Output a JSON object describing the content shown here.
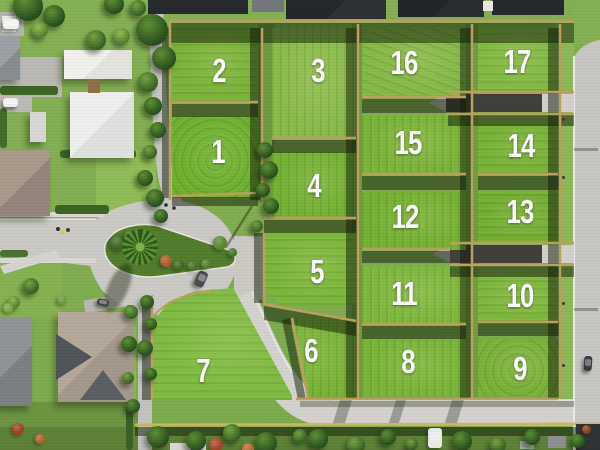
{
  "lots": [
    {
      "label": "1",
      "x": 172,
      "y": 116,
      "w": 86,
      "h": 82,
      "color": "#6db02d",
      "tex": "radial",
      "ang": 0,
      "lx": 218,
      "ly": 152
    },
    {
      "label": "2",
      "x": 172,
      "y": 28,
      "w": 86,
      "h": 74,
      "color": "#7ab238",
      "tex": "linear",
      "ang": 0,
      "lx": 219,
      "ly": 71
    },
    {
      "label": "3",
      "x": 272,
      "y": 28,
      "w": 84,
      "h": 110,
      "color": "#8aba4a",
      "tex": "linear",
      "ang": 90,
      "lx": 318,
      "ly": 71
    },
    {
      "label": "4",
      "x": 272,
      "y": 152,
      "w": 84,
      "h": 66,
      "color": "#74b134",
      "tex": "linear",
      "ang": 90,
      "lx": 314,
      "ly": 186
    },
    {
      "label": "5",
      "x": 264,
      "y": 233,
      "w": 92,
      "h": 72,
      "color": "#7bb63a",
      "tex": "linear",
      "ang": 0,
      "lx": 317,
      "ly": 272,
      "clip": "polygon(0% 0%,100% 0%,100% 100%,16% 100%,0% 74%)"
    },
    {
      "label": "6",
      "x": 264,
      "y": 318,
      "w": 92,
      "h": 80,
      "color": "#78b236",
      "tex": "linear",
      "ang": 90,
      "lx": 311,
      "ly": 351,
      "clip": "polygon(28% 0%,100% 0%,100% 100%,48% 100%)"
    },
    {
      "label": "7",
      "x": 152,
      "y": 288,
      "w": 140,
      "h": 112,
      "color": "#7fbb40",
      "tex": "linear",
      "ang": 0,
      "lx": 203,
      "ly": 371,
      "clip": "polygon(0% 32%,12% 12%,30% 3%,58% 0%,100% 96%,100% 100%,0% 100%)"
    },
    {
      "label": "8",
      "x": 362,
      "y": 340,
      "w": 104,
      "h": 56,
      "color": "#79b437",
      "tex": "linear",
      "ang": 90,
      "lx": 408,
      "ly": 362
    },
    {
      "label": "9",
      "x": 478,
      "y": 340,
      "w": 80,
      "h": 56,
      "color": "#7ab138",
      "tex": "radial",
      "ang": 0,
      "lx": 520,
      "ly": 369
    },
    {
      "label": "10",
      "x": 478,
      "y": 274,
      "w": 80,
      "h": 48,
      "color": "#7db63c",
      "tex": "linear",
      "ang": 0,
      "lx": 520,
      "ly": 296
    },
    {
      "label": "11",
      "x": 362,
      "y": 266,
      "w": 104,
      "h": 59,
      "color": "#7eb73d",
      "tex": "linear",
      "ang": 90,
      "lx": 404,
      "ly": 294
    },
    {
      "label": "12",
      "x": 362,
      "y": 192,
      "w": 104,
      "h": 58,
      "color": "#75b032",
      "tex": "linear",
      "ang": 90,
      "lx": 405,
      "ly": 217
    },
    {
      "label": "13",
      "x": 478,
      "y": 192,
      "w": 80,
      "h": 52,
      "color": "#73ae31",
      "tex": "linear",
      "ang": 0,
      "lx": 520,
      "ly": 212
    },
    {
      "label": "14",
      "x": 478,
      "y": 124,
      "w": 80,
      "h": 50,
      "color": "#77b235",
      "tex": "linear",
      "ang": 0,
      "lx": 521,
      "ly": 146
    },
    {
      "label": "15",
      "x": 362,
      "y": 116,
      "w": 104,
      "h": 59,
      "color": "#7ab338",
      "tex": "linear",
      "ang": 90,
      "lx": 408,
      "ly": 143
    },
    {
      "label": "16",
      "x": 362,
      "y": 28,
      "w": 104,
      "h": 70,
      "color": "#85b846",
      "tex": "linear",
      "ang": 20,
      "lx": 404,
      "ly": 63
    },
    {
      "label": "17",
      "x": 478,
      "y": 28,
      "w": 80,
      "h": 63,
      "color": "#82b942",
      "tex": "linear",
      "ang": 0,
      "lx": 517,
      "ly": 62
    }
  ],
  "palette": {
    "grass_base": "#82ab51",
    "road": "#cbc9c5",
    "road_light": "#dbd9d5",
    "asphalt": "#403e39",
    "fence_tan": "#bba05e",
    "fence_bright": "#cfb35f",
    "shadow": "rgba(16,26,6,0.5)",
    "island_green": "#527c2c",
    "label_white": "#ffffff",
    "roof_dark": "#23262a",
    "roof_white": "#f1f0ec"
  },
  "scenery": {
    "lawns": [
      {
        "x": 96,
        "y": 150,
        "w": 60,
        "h": 68,
        "c": "#8fbb57"
      },
      {
        "x": 56,
        "y": 326,
        "w": 80,
        "h": 76,
        "c": "#8abc52"
      },
      {
        "x": 0,
        "y": 256,
        "w": 62,
        "h": 62,
        "c": "#86b150"
      },
      {
        "x": 0,
        "y": 402,
        "w": 138,
        "h": 48,
        "c": "#6d9441"
      },
      {
        "x": 0,
        "y": 427,
        "w": 600,
        "h": 23,
        "c": "#5d8038"
      },
      {
        "x": 258,
        "y": 24,
        "w": 16,
        "h": 178,
        "c": "#6f9a3e"
      },
      {
        "x": 352,
        "y": 24,
        "w": 10,
        "h": 374,
        "c": "#6f9a3e"
      },
      {
        "x": 466,
        "y": 24,
        "w": 12,
        "h": 374,
        "c": "#719c40"
      },
      {
        "x": 556,
        "y": 22,
        "w": 18,
        "h": 380,
        "c": "#8cb656"
      },
      {
        "x": 574,
        "y": 0,
        "w": 26,
        "h": 44,
        "c": "#84b052"
      }
    ],
    "driveways": [
      {
        "x": 0,
        "y": 12,
        "w": 24,
        "h": 24,
        "c": "#b5b4b0",
        "rot": 0
      },
      {
        "x": 0,
        "y": 57,
        "w": 62,
        "h": 40,
        "c": "#b9b8b4",
        "rot": 0
      },
      {
        "x": 0,
        "y": 96,
        "w": 32,
        "h": 16,
        "c": "#bbbab6",
        "rot": 0
      },
      {
        "x": 84,
        "y": 295,
        "w": 64,
        "h": 13,
        "c": "#b9b7b2",
        "rot": -10
      }
    ],
    "hedges": [
      {
        "x": 0,
        "y": 86,
        "w": 58,
        "h": 9,
        "c": "#3d6323"
      },
      {
        "x": 90,
        "y": 100,
        "w": 9,
        "h": 48,
        "c": "#3a6022"
      },
      {
        "x": 60,
        "y": 150,
        "w": 76,
        "h": 8,
        "c": "#3f6524"
      },
      {
        "x": 55,
        "y": 205,
        "w": 54,
        "h": 9,
        "c": "#3c6322"
      },
      {
        "x": 0,
        "y": 108,
        "w": 7,
        "h": 40,
        "c": "#436a28"
      },
      {
        "x": 126,
        "y": 305,
        "w": 7,
        "h": 145,
        "c": "#3a5f24"
      },
      {
        "x": 0,
        "y": 250,
        "w": 28,
        "h": 7,
        "c": "#4a7030"
      }
    ],
    "houses": [
      {
        "name": "roof-row-top-1",
        "x": 148,
        "y": 0,
        "w": 100,
        "h": 14,
        "c": "#25282c",
        "sh": 0
      },
      {
        "name": "roof-row-top-2",
        "x": 252,
        "y": 0,
        "w": 32,
        "h": 12,
        "c": "#73777b",
        "sh": 0
      },
      {
        "name": "roof-row-top-3",
        "x": 286,
        "y": 0,
        "w": 100,
        "h": 19,
        "c": "#23262a",
        "c2": "#2c3034",
        "sh": 0
      },
      {
        "name": "roof-row-top-4",
        "x": 398,
        "y": 0,
        "w": 86,
        "h": 17,
        "c": "#202327",
        "c2": "#282c30",
        "sh": 0
      },
      {
        "name": "roof-row-top-5",
        "x": 492,
        "y": 0,
        "w": 72,
        "h": 15,
        "c": "#24272b",
        "sh": 0
      },
      {
        "name": "white-roof-top",
        "x": 483,
        "y": 1,
        "w": 10,
        "h": 10,
        "c": "#e8e7e3",
        "sh": 0
      },
      {
        "name": "white-house-upper",
        "x": 64,
        "y": 50,
        "w": 68,
        "h": 29,
        "c": "#f2f1ed",
        "c2": "#e4e3de",
        "sh": 1
      },
      {
        "name": "white-house-lower",
        "x": 70,
        "y": 92,
        "w": 64,
        "h": 66,
        "c": "#eef0ee",
        "c2": "#dfe1df",
        "sh": 1
      },
      {
        "name": "deck",
        "x": 88,
        "y": 79,
        "w": 12,
        "h": 14,
        "c": "#8f6f45",
        "sh": 0
      },
      {
        "name": "garage",
        "x": 30,
        "y": 112,
        "w": 16,
        "h": 30,
        "c": "#d7d7d3",
        "sh": 1
      },
      {
        "name": "gray-house-topleft",
        "x": 0,
        "y": 36,
        "w": 20,
        "h": 44,
        "c": "#9aa0a3",
        "c2": "#878c8f",
        "sh": 1
      },
      {
        "name": "white-shed-topleft",
        "x": 2,
        "y": 16,
        "w": 14,
        "h": 16,
        "c": "#e9e9e6",
        "sh": 0
      },
      {
        "name": "tan-house-left",
        "x": 0,
        "y": 150,
        "w": 50,
        "h": 66,
        "c": "#a89a88",
        "c2": "#93857a",
        "sh": 1
      },
      {
        "name": "gray-house-bottomleft",
        "x": 0,
        "y": 318,
        "w": 32,
        "h": 88,
        "c": "#8e9396",
        "c2": "#7b8083",
        "sh": 1
      },
      {
        "name": "beige-house",
        "x": 58,
        "y": 312,
        "w": 76,
        "h": 90,
        "c": "#b4a89a",
        "c2": "#a4988a",
        "style": "gabled",
        "sh": 1
      },
      {
        "name": "white-roof-bottom",
        "x": 170,
        "y": 443,
        "w": 36,
        "h": 7,
        "c": "#d9d8d4",
        "sh": 0
      },
      {
        "name": "dark-shed-bottomright",
        "x": 576,
        "y": 424,
        "w": 24,
        "h": 26,
        "c": "#2e3234",
        "sh": 0
      },
      {
        "name": "gray-shed-bottomright",
        "x": 548,
        "y": 436,
        "w": 18,
        "h": 12,
        "c": "#8c9092",
        "sh": 0
      },
      {
        "name": "shed-bottom",
        "x": 520,
        "y": 441,
        "w": 14,
        "h": 8,
        "c": "#a9adaf",
        "sh": 0
      }
    ],
    "trees": [
      {
        "cx": 28,
        "cy": 6,
        "d": 30,
        "t": "dark"
      },
      {
        "cx": 54,
        "cy": 16,
        "d": 22,
        "t": "dark"
      },
      {
        "cx": 114,
        "cy": 4,
        "d": 20,
        "t": "dark"
      },
      {
        "cx": 138,
        "cy": 8,
        "d": 16,
        "t": "mid"
      },
      {
        "cx": 152,
        "cy": 30,
        "d": 32,
        "t": "dark"
      },
      {
        "cx": 164,
        "cy": 58,
        "d": 24,
        "t": "dark"
      },
      {
        "cx": 148,
        "cy": 82,
        "d": 20,
        "t": "mid"
      },
      {
        "cx": 96,
        "cy": 40,
        "d": 20,
        "t": "mid"
      },
      {
        "cx": 122,
        "cy": 36,
        "d": 16,
        "t": "light"
      },
      {
        "cx": 40,
        "cy": 30,
        "d": 16,
        "t": "light"
      },
      {
        "cx": 153,
        "cy": 106,
        "d": 18,
        "t": "dark"
      },
      {
        "cx": 158,
        "cy": 130,
        "d": 16,
        "t": "dark"
      },
      {
        "cx": 150,
        "cy": 152,
        "d": 14,
        "t": "mid"
      },
      {
        "cx": 145,
        "cy": 178,
        "d": 16,
        "t": "dark"
      },
      {
        "cx": 155,
        "cy": 198,
        "d": 18,
        "t": "dark"
      },
      {
        "cx": 161,
        "cy": 216,
        "d": 14,
        "t": "dark"
      },
      {
        "cx": 265,
        "cy": 150,
        "d": 16,
        "t": "dark"
      },
      {
        "cx": 269,
        "cy": 170,
        "d": 18,
        "t": "dark"
      },
      {
        "cx": 263,
        "cy": 190,
        "d": 14,
        "t": "dark"
      },
      {
        "cx": 271,
        "cy": 206,
        "d": 16,
        "t": "dark"
      },
      {
        "cx": 257,
        "cy": 226,
        "d": 12,
        "t": "mid"
      },
      {
        "cx": 147,
        "cy": 302,
        "d": 14,
        "t": "dark"
      },
      {
        "cx": 151,
        "cy": 324,
        "d": 12,
        "t": "dark"
      },
      {
        "cx": 145,
        "cy": 348,
        "d": 16,
        "t": "dark"
      },
      {
        "cx": 151,
        "cy": 374,
        "d": 12,
        "t": "dark"
      },
      {
        "cx": 131,
        "cy": 312,
        "d": 14,
        "t": "mid"
      },
      {
        "cx": 129,
        "cy": 344,
        "d": 16,
        "t": "dark"
      },
      {
        "cx": 128,
        "cy": 378,
        "d": 12,
        "t": "mid"
      },
      {
        "cx": 133,
        "cy": 406,
        "d": 14,
        "t": "dark"
      },
      {
        "cx": 31,
        "cy": 286,
        "d": 16,
        "t": "mid"
      },
      {
        "cx": 14,
        "cy": 302,
        "d": 12,
        "t": "light"
      },
      {
        "cx": 158,
        "cy": 437,
        "d": 22,
        "t": "dark"
      },
      {
        "cx": 196,
        "cy": 441,
        "d": 20,
        "t": "dark"
      },
      {
        "cx": 232,
        "cy": 433,
        "d": 18,
        "t": "mid"
      },
      {
        "cx": 266,
        "cy": 443,
        "d": 22,
        "t": "dark"
      },
      {
        "cx": 318,
        "cy": 439,
        "d": 20,
        "t": "dark"
      },
      {
        "cx": 356,
        "cy": 445,
        "d": 18,
        "t": "mid"
      },
      {
        "cx": 388,
        "cy": 437,
        "d": 16,
        "t": "dark"
      },
      {
        "cx": 462,
        "cy": 441,
        "d": 20,
        "t": "dark"
      },
      {
        "cx": 498,
        "cy": 445,
        "d": 16,
        "t": "mid"
      },
      {
        "cx": 532,
        "cy": 437,
        "d": 16,
        "t": "dark"
      },
      {
        "cx": 578,
        "cy": 441,
        "d": 14,
        "t": "dark"
      },
      {
        "cx": 300,
        "cy": 436,
        "d": 14,
        "t": "mid"
      },
      {
        "cx": 412,
        "cy": 444,
        "d": 12,
        "t": "mid"
      }
    ],
    "shrubs": [
      {
        "cx": 216,
        "cy": 445,
        "d": 14,
        "c": "#a34527"
      },
      {
        "cx": 248,
        "cy": 449,
        "d": 12,
        "c": "#b66a2e"
      },
      {
        "cx": 18,
        "cy": 429,
        "d": 12,
        "c": "#9c4122"
      },
      {
        "cx": 40,
        "cy": 439,
        "d": 10,
        "c": "#b0622c"
      },
      {
        "cx": 586,
        "cy": 429,
        "d": 9,
        "c": "#8f3d20"
      },
      {
        "cx": 166,
        "cy": 261,
        "d": 12,
        "c": "#b05a28"
      },
      {
        "cx": 178,
        "cy": 265,
        "d": 11,
        "c": "#3e6823"
      },
      {
        "cx": 192,
        "cy": 266,
        "d": 10,
        "c": "#477228"
      },
      {
        "cx": 206,
        "cy": 264,
        "d": 10,
        "c": "#527e2c"
      },
      {
        "cx": 220,
        "cy": 243,
        "d": 14,
        "c": "#5a8730"
      },
      {
        "cx": 232,
        "cy": 252,
        "d": 9,
        "c": "#487327"
      },
      {
        "cx": 118,
        "cy": 243,
        "d": 16,
        "c": "#3c6621"
      },
      {
        "cx": 130,
        "cy": 236,
        "d": 12,
        "c": "#447026"
      },
      {
        "cx": 62,
        "cy": 300,
        "d": 10,
        "c": "#6c9a3c"
      },
      {
        "cx": 8,
        "cy": 308,
        "d": 10,
        "c": "#7ca645"
      }
    ],
    "cars": [
      {
        "name": "white-van-topleft",
        "x": 3,
        "y": 19,
        "w": 16,
        "h": 10,
        "c": "#f2f2f0",
        "rot": 0
      },
      {
        "name": "white-car-driveway",
        "x": 3,
        "y": 98,
        "w": 15,
        "h": 9,
        "c": "#eff0ee",
        "rot": 0
      },
      {
        "name": "dark-car-driveway",
        "x": 97,
        "y": 299,
        "w": 12,
        "h": 7,
        "c": "#3f4346",
        "rot": 12
      },
      {
        "name": "car-on-culdesac",
        "x": 196,
        "y": 271,
        "w": 10,
        "h": 16,
        "c": "#474a4e",
        "rot": 24
      },
      {
        "name": "car-right-road",
        "x": 584,
        "y": 356,
        "w": 8,
        "h": 15,
        "c": "#35383c",
        "rot": 4
      },
      {
        "name": "white-truck-bottom",
        "x": 428,
        "y": 428,
        "w": 14,
        "h": 20,
        "c": "#e9e9e5",
        "rot": 0
      }
    ],
    "people": [
      {
        "x": 56,
        "y": 227,
        "c": "#2c2c2c"
      },
      {
        "x": 61,
        "y": 230,
        "c": "#d9cb2e"
      },
      {
        "x": 66,
        "y": 228,
        "c": "#3c3c3c"
      }
    ],
    "posts": [
      {
        "x": 562,
        "y": 118
      },
      {
        "x": 562,
        "y": 176
      },
      {
        "x": 562,
        "y": 302
      },
      {
        "x": 562,
        "y": 364
      }
    ]
  }
}
